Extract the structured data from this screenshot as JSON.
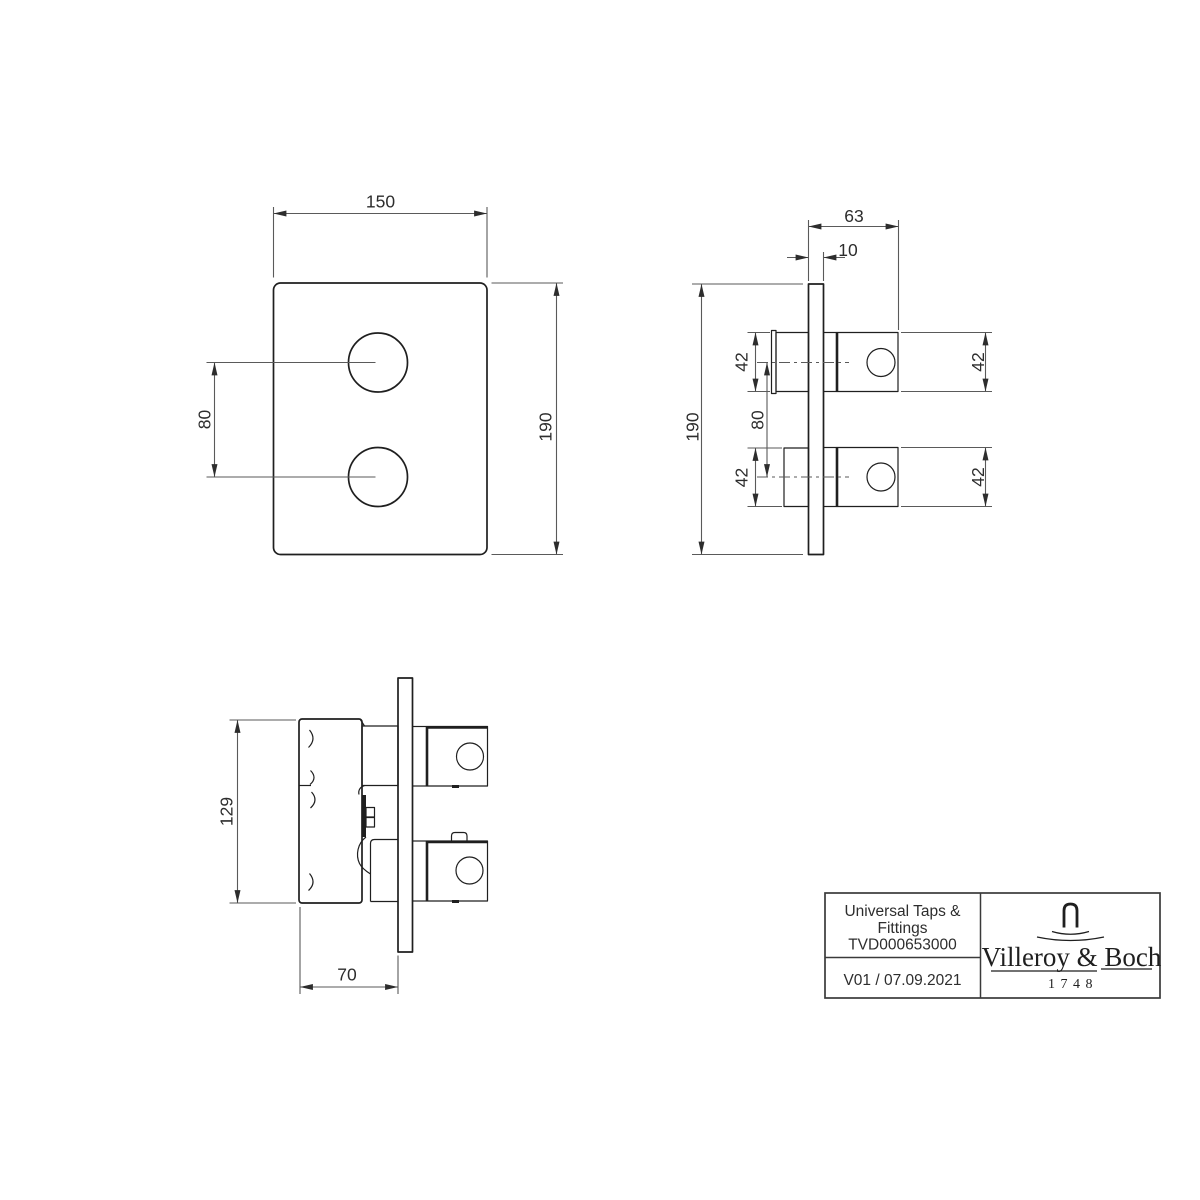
{
  "drawing": {
    "front_view": {
      "width": "150",
      "height": "190",
      "hole_spacing": "80"
    },
    "side_view": {
      "protrusion_depth": "63",
      "plate_thickness": "10",
      "height": "190",
      "hole_spacing": "80",
      "upper_body_height_left": "42",
      "lower_body_height_left": "42",
      "upper_body_height_right": "42",
      "lower_body_height_right": "42"
    },
    "bottom_view": {
      "body_height": "129",
      "body_depth": "70"
    }
  },
  "title_block": {
    "product_line1": "Universal Taps &",
    "product_line2": "Fittings",
    "article_number": "TVD000653000",
    "revision": "V01 / 07.09.2021",
    "brand_name": "Villeroy & Boch",
    "brand_year": "1748",
    "logo_icon": "tap-icon"
  },
  "colors": {
    "background": "#ffffff",
    "object_line": "#1f1f1f",
    "dimension_line": "#5a5a5a",
    "text": "#2d2d2d"
  }
}
